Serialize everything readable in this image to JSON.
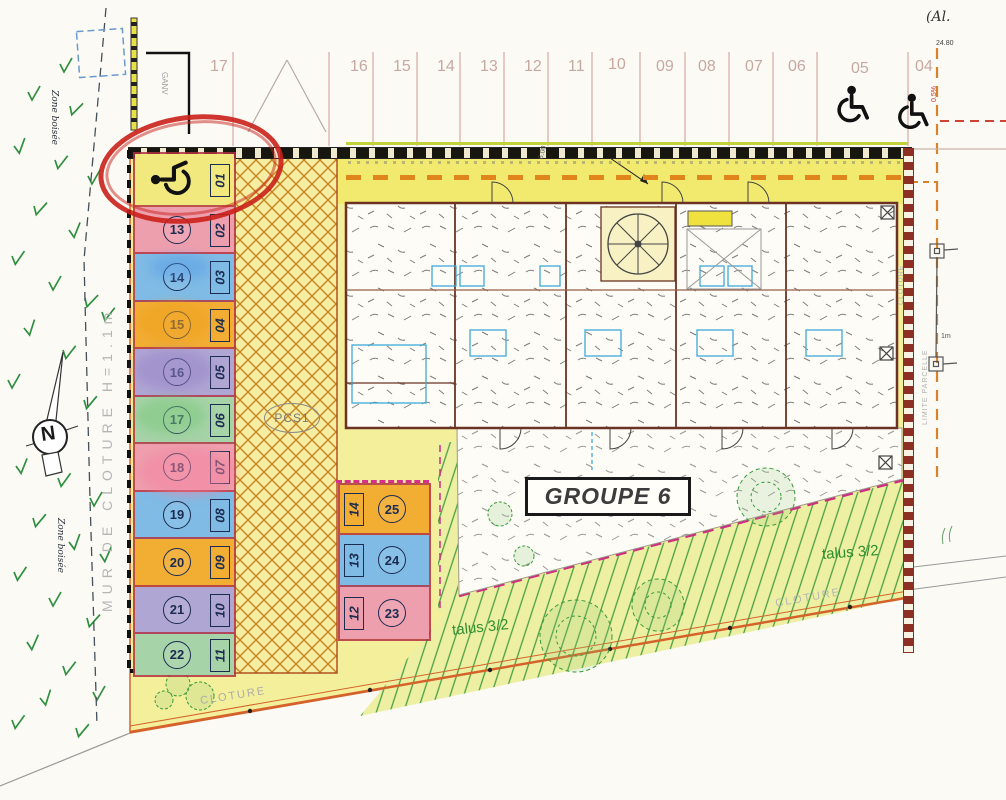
{
  "labels": {
    "note_top_right": "(Al.",
    "dim_top_right": "24.80",
    "slope": "0.5%",
    "dim_strip": "6.00",
    "ganv": "GANV",
    "zone_boisee_top": "Zone boisée",
    "zone_boisee_bottom": "Zone boisée",
    "mur_cloture": "MUR DE CLOTURE H=1.1m",
    "pcs1": "PCS1",
    "groupe": "GROUPE 6",
    "talus_left": "talus 3/2",
    "talus_right": "talus 3/2",
    "cloture_bottom_left": "CLOTURE",
    "cloture_bottom_right": "CLOTURE",
    "cloture_right": "CLOTURE",
    "limite_parcelle": "LIMITE PARCELLE",
    "marker_dim": "1m",
    "north": "N"
  },
  "top_bays": {
    "labels": [
      "17",
      "16",
      "15",
      "14",
      "13",
      "12",
      "11",
      "10",
      "09",
      "08",
      "07",
      "06",
      "05",
      "04"
    ]
  },
  "parking_left": {
    "stalls": [
      {
        "box": "01",
        "circle": "",
        "color": "#f1e97d",
        "icon": "wheelchair"
      },
      {
        "box": "02",
        "circle": "13",
        "color": "#ee9fae"
      },
      {
        "box": "03",
        "circle": "14",
        "color": "#7fbbe5"
      },
      {
        "box": "04",
        "circle": "15",
        "color": "#f2ad33"
      },
      {
        "box": "05",
        "circle": "16",
        "color": "#b0a6d4"
      },
      {
        "box": "06",
        "circle": "17",
        "color": "#a6d3a8"
      },
      {
        "box": "07",
        "circle": "18",
        "color": "#ee9fae"
      },
      {
        "box": "08",
        "circle": "19",
        "color": "#7fbbe5"
      },
      {
        "box": "09",
        "circle": "20",
        "color": "#f2ad33"
      },
      {
        "box": "10",
        "circle": "21",
        "color": "#b0a6d4"
      },
      {
        "box": "11",
        "circle": "22",
        "color": "#a6d3a8"
      }
    ]
  },
  "parking_bottom": {
    "stalls": [
      {
        "box": "14",
        "circle": "25",
        "color": "#f2ad33"
      },
      {
        "box": "13",
        "circle": "24",
        "color": "#7fbbe5"
      },
      {
        "box": "12",
        "circle": "23",
        "color": "#ee9fae"
      }
    ]
  },
  "icons": {
    "handicap": "wheelchair-symbol",
    "north": "north-arrow-compass"
  },
  "colors": {
    "site_yellow": "#f4ef9b",
    "annotation_red": "#ca201a",
    "magenta_boundary": "#cf2d7f",
    "talus_green": "#4a9e44",
    "driveway_orange_dash": "#e0841c",
    "boundary_brown": "#8e2f23"
  }
}
